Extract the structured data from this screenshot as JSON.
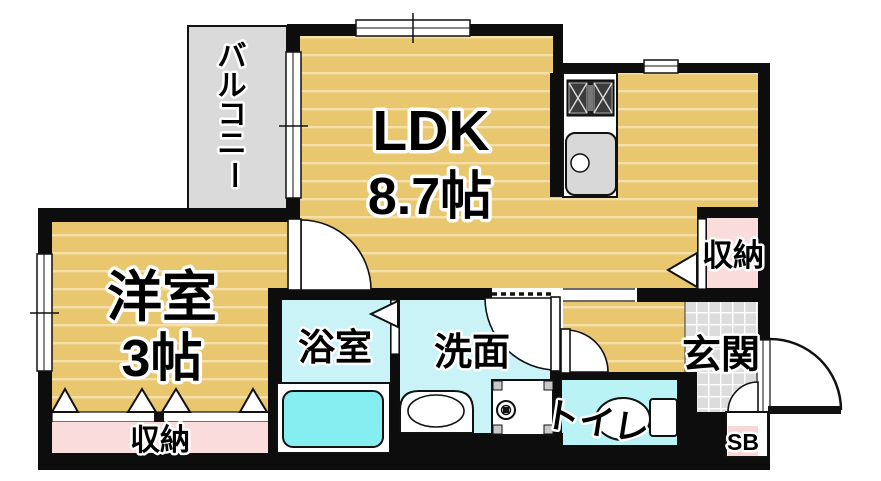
{
  "plan": {
    "title": "1LDK floor plan",
    "rooms": {
      "balcony": {
        "label": "バルコニー",
        "label_chars": [
          "バ",
          "ル",
          "コ",
          "ニ",
          "ー"
        ]
      },
      "ldk": {
        "name": "LDK",
        "size": "8.7帖"
      },
      "western_room": {
        "name": "洋室",
        "size": "3帖"
      },
      "bathroom": {
        "label": "浴室"
      },
      "washroom": {
        "label": "洗面"
      },
      "toilet": {
        "label": "トイレ"
      },
      "entrance": {
        "label": "玄関"
      },
      "storage_top": {
        "label": "収納"
      },
      "storage_bottom": {
        "label": "収納"
      },
      "shoe_box": {
        "label": "SB"
      }
    },
    "colors": {
      "tatami_floor": "#e9c76f",
      "tatami_stripe": "#f5e0a8",
      "balcony_gray": "#dadada",
      "entrance_tile": "#dcdcdc",
      "closet_pink": "#fadcdd",
      "wet_room_cyan": "#c9f3f7",
      "toilet_cyan": "#baf3f5",
      "bathtub_cyan": "#85eef0",
      "wall_black": "#0d0d0d"
    }
  }
}
